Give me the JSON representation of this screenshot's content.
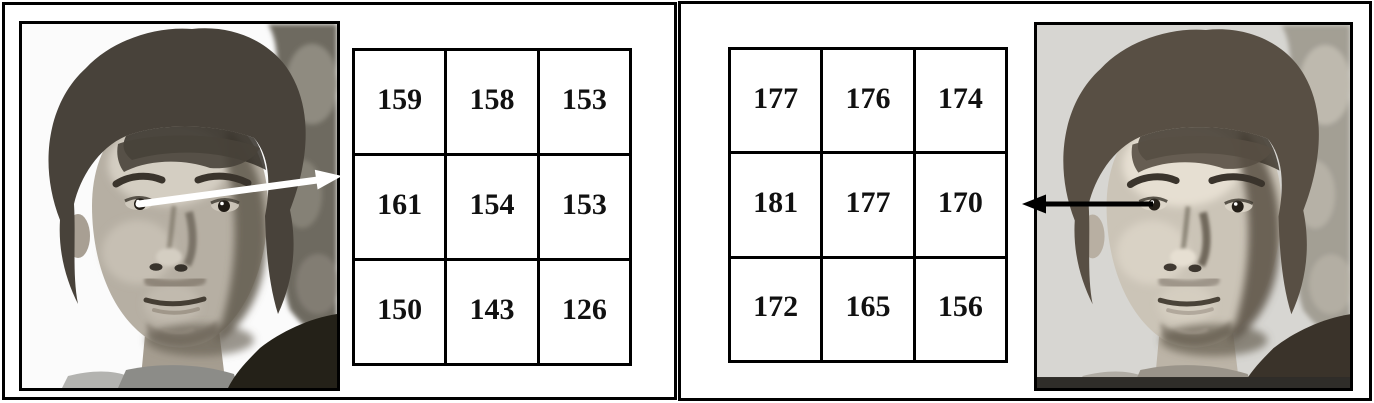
{
  "left_panel": {
    "photo": "male-face-grayscale-photo-white-background",
    "grid": [
      [
        "159",
        "158",
        "153"
      ],
      [
        "161",
        "154",
        "153"
      ],
      [
        "150",
        "143",
        "126"
      ]
    ],
    "arrow": {
      "direction": "right-from-eye-to-grid",
      "color": "#ffffff"
    }
  },
  "right_panel": {
    "grid": [
      [
        "177",
        "176",
        "174"
      ],
      [
        "181",
        "177",
        "170"
      ],
      [
        "172",
        "165",
        "156"
      ]
    ],
    "arrow": {
      "direction": "left-from-eye-to-grid",
      "color": "#000000"
    },
    "photo": "male-face-grayscale-photo-gray-background"
  },
  "colors": {
    "panel_border": "#000000",
    "panel_background": "#ffffff",
    "left_photo_background": "#fbfbfb",
    "right_photo_background": "#d7d6d2"
  }
}
